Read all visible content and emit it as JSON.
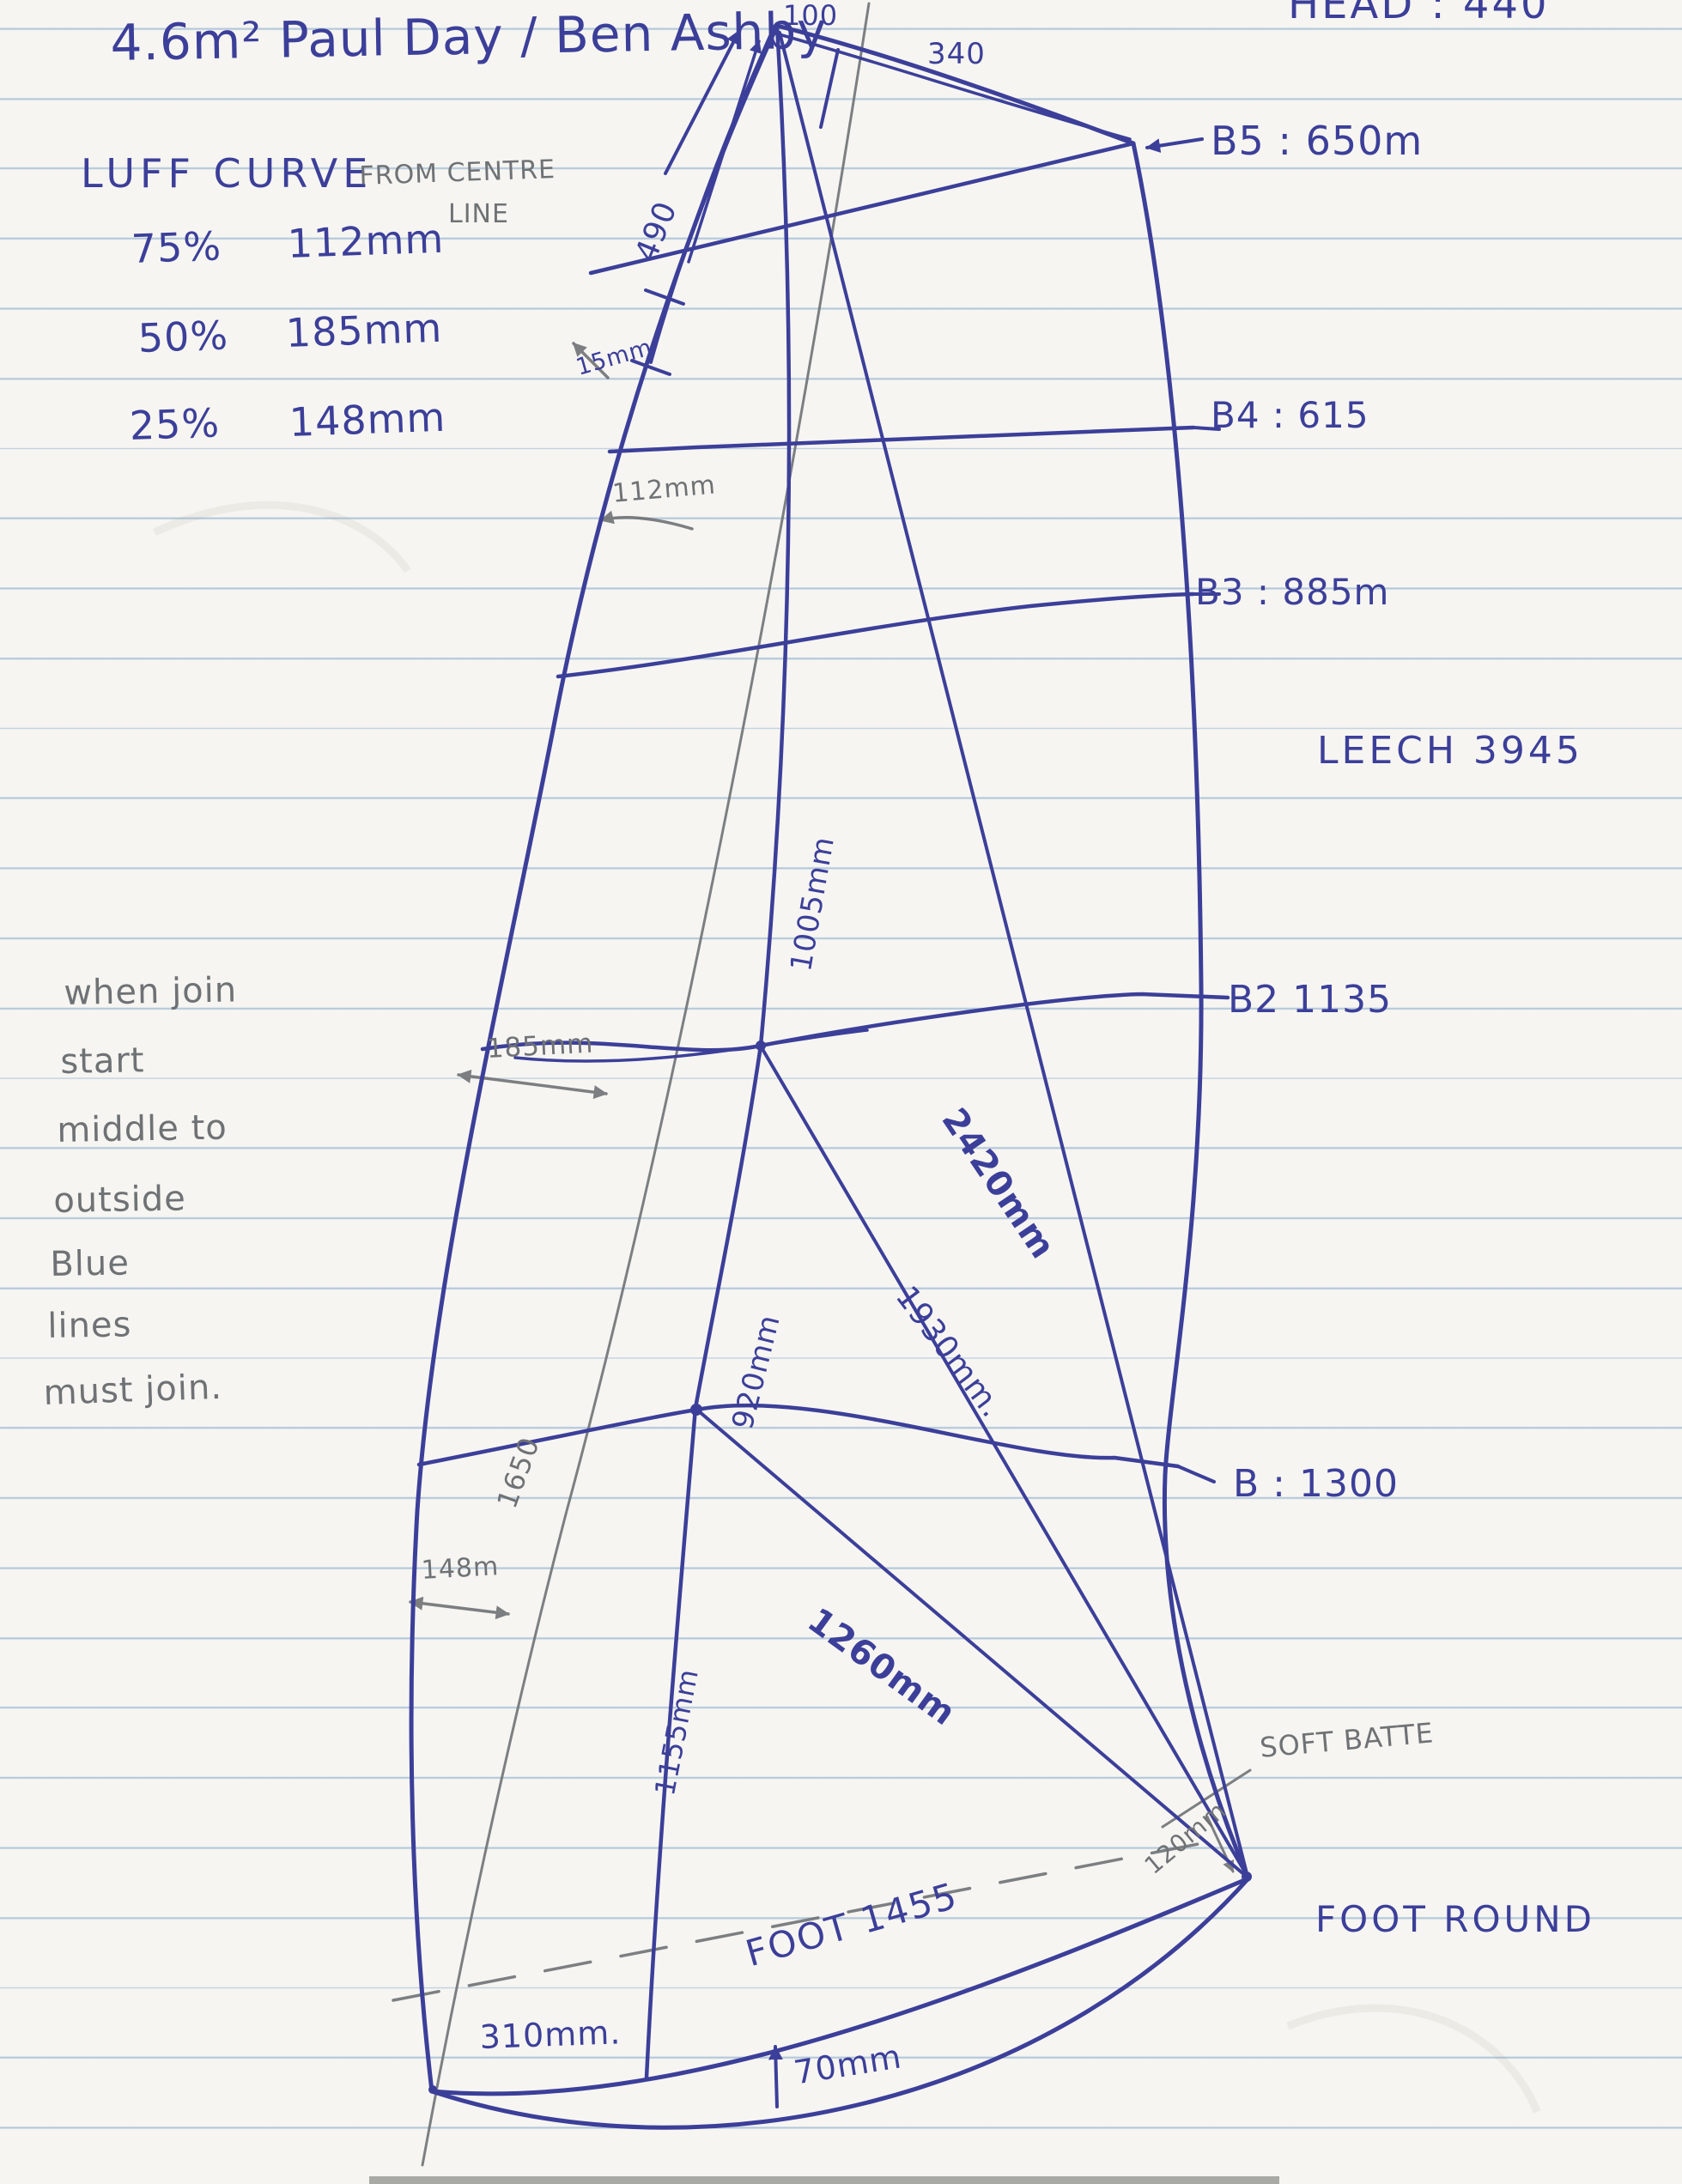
{
  "colors": {
    "ink": "#3c3f99",
    "pencil": "#6f7275",
    "paper": "#f6f5f1",
    "rule": "#b3c9df"
  },
  "title": "4.6m²  Paul Day / Ben Ashby",
  "head_note": "HEAD : 440",
  "luff_curve": {
    "heading": "LUFF CURVE",
    "subheading_line1": "FROM CENTRE",
    "subheading_line2": "LINE",
    "rows": [
      {
        "pct": "75%",
        "value": "112mm"
      },
      {
        "pct": "50%",
        "value": "185mm"
      },
      {
        "pct": "25%",
        "value": "148mm"
      }
    ]
  },
  "side_note": {
    "lines": [
      "when join",
      "start",
      "middle to",
      "outside",
      "Blue",
      "lines",
      "must join."
    ]
  },
  "labels": {
    "head_width": "100",
    "head_340": "340",
    "luff_490": "490",
    "luff_15mm": "15mm",
    "b5": "B5 : 650m",
    "b4": "B4 : 615",
    "b3": "B3 : 885m",
    "leech": "LEECH 3945",
    "b2": "B2  1135",
    "mm112": "112mm",
    "mm185": "185mm",
    "mm1005": "1005mm",
    "mm2420": "2420mm",
    "mm1930": "1930mm.",
    "mm920": "920mm",
    "centre_1650": "1650",
    "b1": "B : 1300",
    "mm148": "148m",
    "mm1155": "1155mm",
    "mm1260": "1260mm",
    "soft_batten": "SOFT BATTE",
    "mm120": "120mm",
    "foot_round": "FOOT ROUND",
    "foot_length": "FOOT 1455",
    "mm70": "70mm",
    "mm310": "310mm."
  }
}
